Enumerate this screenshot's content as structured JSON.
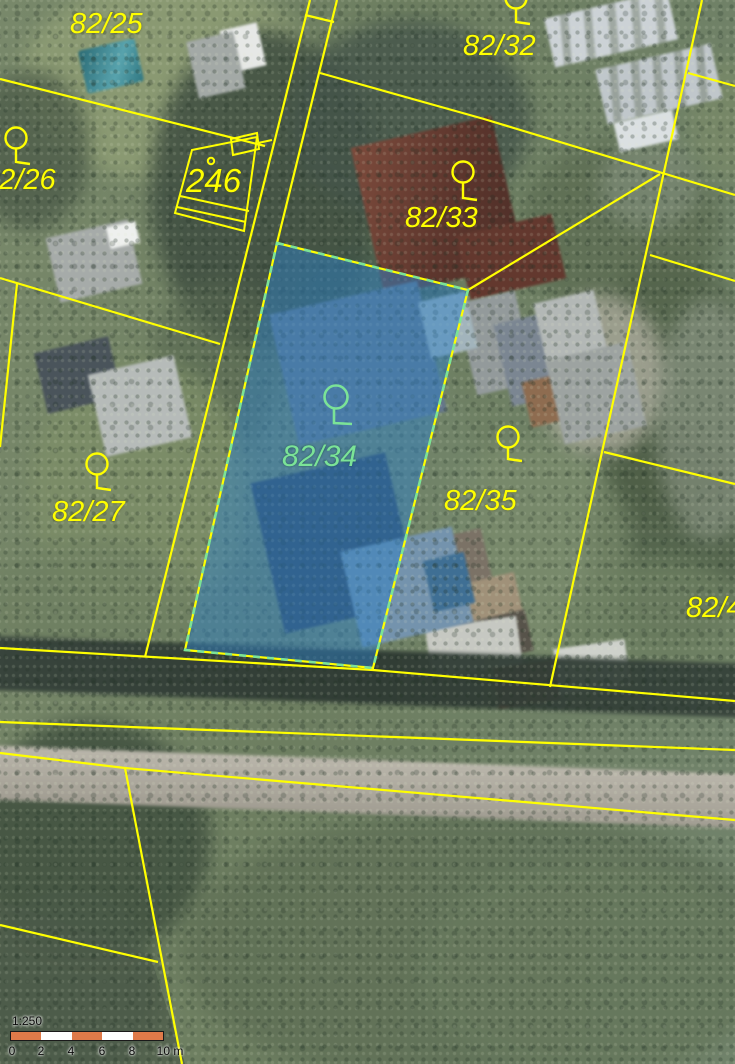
{
  "map": {
    "highlighted_parcel": "82/34"
  },
  "parcel_labels": {
    "p82_25": "82/25",
    "p82_26": "82/26",
    "p82_27": "82/27",
    "p82_32": "82/32",
    "p82_33": "82/33",
    "p82_34": "82/34",
    "p82_35": "82/35",
    "p82_4": "82/4"
  },
  "building_labels": {
    "b246": "246"
  },
  "scalebar": {
    "ratio": "1:250",
    "ticks": [
      "0",
      "2",
      "4",
      "6",
      "8",
      "10 m"
    ]
  },
  "colors": {
    "boundary_line": "#ffff00",
    "parcel_label": "#ffff00",
    "highlight_fill": "#2d7fc4",
    "highlight_dash": "#7be397",
    "highlight_label": "#7be397",
    "scalebar_orange": "#df7a49"
  },
  "markers": {
    "parcels_with_symbol": [
      "82/26",
      "82/32",
      "82/33",
      "82/27",
      "82/34",
      "82/35"
    ]
  }
}
